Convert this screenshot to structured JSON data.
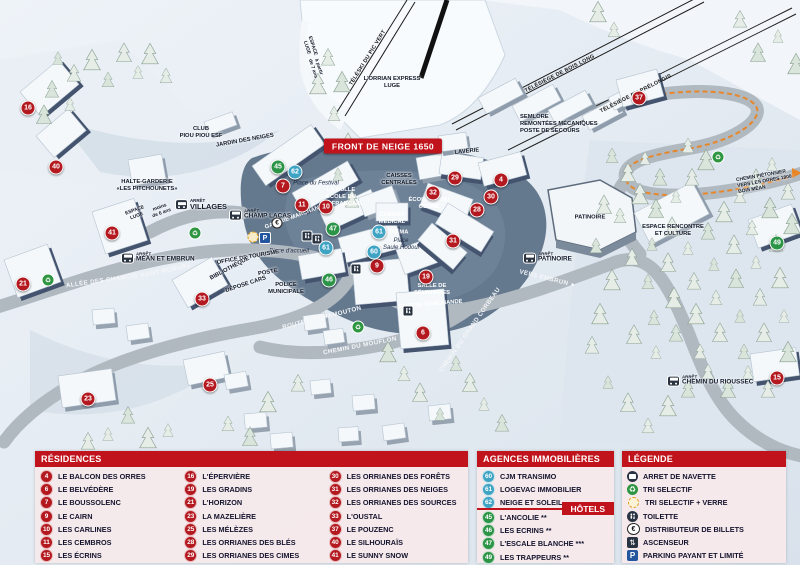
{
  "colors": {
    "accent_red": "#c1131b",
    "marker_red": "#b3191f",
    "marker_green": "#2c9447",
    "marker_blue": "#3fa3c4",
    "trail_orange": "#e8872a",
    "parking_blue": "#2456a0"
  },
  "map": {
    "banner": "FRONT DE NEIGE 1650",
    "markers": [
      {
        "n": "16",
        "c": "red",
        "x": 28,
        "y": 108
      },
      {
        "n": "40",
        "c": "red",
        "x": 56,
        "y": 167
      },
      {
        "n": "21",
        "c": "red",
        "x": 23,
        "y": 284
      },
      {
        "n": "41",
        "c": "red",
        "x": 112,
        "y": 233
      },
      {
        "n": "33",
        "c": "red",
        "x": 202,
        "y": 299
      },
      {
        "n": "23",
        "c": "red",
        "x": 88,
        "y": 399
      },
      {
        "n": "25",
        "c": "red",
        "x": 210,
        "y": 385
      },
      {
        "n": "7",
        "c": "red",
        "x": 283,
        "y": 186
      },
      {
        "n": "11",
        "c": "red",
        "x": 302,
        "y": 205
      },
      {
        "n": "10",
        "c": "red",
        "x": 326,
        "y": 207
      },
      {
        "n": "9",
        "c": "red",
        "x": 377,
        "y": 266
      },
      {
        "n": "19",
        "c": "red",
        "x": 426,
        "y": 277
      },
      {
        "n": "6",
        "c": "red",
        "x": 423,
        "y": 333
      },
      {
        "n": "29",
        "c": "red",
        "x": 455,
        "y": 178
      },
      {
        "n": "4",
        "c": "red",
        "x": 501,
        "y": 180
      },
      {
        "n": "30",
        "c": "red",
        "x": 491,
        "y": 197
      },
      {
        "n": "32",
        "c": "red",
        "x": 433,
        "y": 193
      },
      {
        "n": "28",
        "c": "red",
        "x": 477,
        "y": 210
      },
      {
        "n": "31",
        "c": "red",
        "x": 453,
        "y": 241
      },
      {
        "n": "37",
        "c": "red",
        "x": 639,
        "y": 98
      },
      {
        "n": "15",
        "c": "red",
        "x": 777,
        "y": 378
      },
      {
        "n": "45",
        "c": "green",
        "x": 278,
        "y": 167
      },
      {
        "n": "47",
        "c": "green",
        "x": 333,
        "y": 229
      },
      {
        "n": "46",
        "c": "green",
        "x": 329,
        "y": 280
      },
      {
        "n": "49",
        "c": "green",
        "x": 777,
        "y": 243
      },
      {
        "n": "62",
        "c": "blue",
        "x": 295,
        "y": 172
      },
      {
        "n": "61",
        "c": "blue",
        "x": 326,
        "y": 248
      },
      {
        "n": "60",
        "c": "blue",
        "x": 374,
        "y": 252
      },
      {
        "n": "61",
        "c": "blue",
        "x": 379,
        "y": 232
      }
    ],
    "labels": [
      {
        "t": "LAVERIE",
        "x": 467,
        "y": 152,
        "r": -6,
        "c": "dk"
      },
      {
        "t": "CAISSES\nCENTRALES",
        "x": 399,
        "y": 180,
        "r": 0,
        "c": "dk"
      },
      {
        "t": "ÉCOLE DE SKI\nOZONE",
        "x": 429,
        "y": 204,
        "r": 0,
        "c": "wt"
      },
      {
        "t": "LA BULLE\nÉCOLE DU\nSKI FRANÇAIS",
        "x": 341,
        "y": 197,
        "r": 0,
        "c": "wt"
      },
      {
        "t": "GALERIE MARCHANDE",
        "x": 296,
        "y": 217,
        "r": -20,
        "c": "wt"
      },
      {
        "t": "CABINET\nMÉDICAL",
        "x": 392,
        "y": 219,
        "r": 0,
        "c": "wt"
      },
      {
        "t": "CINÉMA",
        "x": 397,
        "y": 233,
        "r": 0,
        "c": "wt"
      },
      {
        "t": "SALLE DE\nSÉMINAIRES",
        "x": 432,
        "y": 290,
        "r": 0,
        "c": "wt"
      },
      {
        "t": "GALERIE MARCHANDE",
        "x": 430,
        "y": 305,
        "r": -5,
        "c": "wt"
      },
      {
        "t": "Place du Festival",
        "x": 316,
        "y": 184,
        "r": 0,
        "c": "it"
      },
      {
        "t": "Place d'accueil",
        "x": 289,
        "y": 252,
        "r": 0,
        "c": "it"
      },
      {
        "t": "Place\nSaule Hodoul",
        "x": 401,
        "y": 245,
        "r": 0,
        "c": "it"
      },
      {
        "t": "OFFICE DE TOURISME",
        "x": 248,
        "y": 258,
        "r": -10,
        "c": "dk"
      },
      {
        "t": "BIBLIOTHÈQUE",
        "x": 230,
        "y": 269,
        "r": -28,
        "c": "dk"
      },
      {
        "t": "POSTE",
        "x": 268,
        "y": 273,
        "r": -10,
        "c": "dk"
      },
      {
        "t": "DÉPOSE CARS",
        "x": 246,
        "y": 285,
        "r": -18,
        "c": "dk"
      },
      {
        "t": "POLICE\nMUNICIPALE",
        "x": 286,
        "y": 289,
        "r": 0,
        "c": "dk"
      },
      {
        "t": "HALTE-GARDERIE\n«LES PITCHOUNETS»",
        "x": 147,
        "y": 186,
        "r": 0,
        "c": "dk"
      },
      {
        "t": "CLUB\nPIOU PIOU ESF",
        "x": 201,
        "y": 133,
        "r": 0,
        "c": "dk"
      },
      {
        "t": "JARDIN DES NEIGES",
        "x": 245,
        "y": 141,
        "r": -10,
        "c": "dk"
      },
      {
        "t": "ESPACE\nLUGE",
        "x": 136,
        "y": 214,
        "r": -20,
        "c": "dk",
        "s": true
      },
      {
        "t": "moins\nde 6 ans",
        "x": 161,
        "y": 211,
        "r": -20,
        "c": "dk",
        "s": true
      },
      {
        "t": "ESPACE\nLUGE",
        "x": 309,
        "y": 47,
        "r": 72,
        "c": "dk",
        "s": true
      },
      {
        "t": "à partir\nde 7 ans",
        "x": 315,
        "y": 68,
        "r": 72,
        "c": "dk",
        "s": true
      },
      {
        "t": "ESPACE RENCONTRE\nET CULTURE",
        "x": 673,
        "y": 231,
        "r": 0,
        "c": "dk"
      },
      {
        "t": "PATINOIRE",
        "x": 590,
        "y": 218,
        "r": 0,
        "c": "dk"
      },
      {
        "t": "L'ORRIAN EXPRESS\nLUGE",
        "x": 392,
        "y": 83,
        "r": 0,
        "c": "dk"
      },
      {
        "t": "SEMLORE\nREMONTÉES MÉCANIQUES\nPOSTE DE SECOURS",
        "x": 520,
        "y": 124,
        "r": 0,
        "c": "dk",
        "a": "left"
      },
      {
        "t": "CHEMIN PIÉTONNIER\nVERS LES ORRES 1800\nBOIS MÉAN",
        "x": 737,
        "y": 182,
        "r": -10,
        "c": "dk",
        "s": true,
        "a": "left"
      },
      {
        "t": "ALLÉE DES CHAMOIS",
        "x": 102,
        "y": 281,
        "r": -8,
        "c": "road"
      },
      {
        "t": "PONT MOBURS",
        "x": 166,
        "y": 271,
        "r": -12,
        "c": "road"
      },
      {
        "t": "ROUTE DE PRAMOUTON",
        "x": 322,
        "y": 318,
        "r": -14,
        "c": "road"
      },
      {
        "t": "CHEMIN DU MOUFLON",
        "x": 360,
        "y": 346,
        "r": -11,
        "c": "road"
      },
      {
        "t": "CHEMIN DU GRAND CORBEAU",
        "x": 470,
        "y": 330,
        "r": -55,
        "c": "road"
      },
      {
        "t": "VERS EMBRUN ►",
        "x": 548,
        "y": 279,
        "r": 14,
        "c": "road"
      },
      {
        "t": "TÉLÉSKI DU PIC VERT",
        "x": 368,
        "y": 58,
        "r": -58,
        "c": "lift"
      },
      {
        "t": "TÉLÉSIÈGE DE BOIS LONG",
        "x": 560,
        "y": 74,
        "r": -27,
        "c": "lift"
      },
      {
        "t": "TÉLÉSIÈGE DU PRÉLONGIS",
        "x": 636,
        "y": 94,
        "r": -27,
        "c": "lift"
      }
    ],
    "stops": [
      {
        "small": "ARRÊT",
        "name": "VILLAGES",
        "x": 176,
        "y": 205,
        "big": true
      },
      {
        "small": "ARRÊT",
        "name": "CHAMP LACAS",
        "x": 230,
        "y": 215
      },
      {
        "small": "ARRÊT",
        "name": "MÉAN ET EMBRUN",
        "x": 122,
        "y": 258
      },
      {
        "small": "ARRÊT",
        "name": "PATINOIRE",
        "x": 524,
        "y": 258
      },
      {
        "small": "ARRÊT",
        "name": "CHEMIN DU RIOUSSEC",
        "x": 668,
        "y": 381
      }
    ],
    "icons": [
      {
        "type": "recycle",
        "x": 48,
        "y": 280
      },
      {
        "type": "recycle",
        "x": 195,
        "y": 233
      },
      {
        "type": "recycle",
        "x": 358,
        "y": 327
      },
      {
        "type": "recycle",
        "x": 718,
        "y": 157
      },
      {
        "type": "wc",
        "x": 307,
        "y": 236
      },
      {
        "type": "wc",
        "x": 317,
        "y": 239
      },
      {
        "type": "wc",
        "x": 356,
        "y": 269
      },
      {
        "type": "wc",
        "x": 408,
        "y": 311
      },
      {
        "type": "euro",
        "x": 277,
        "y": 223
      },
      {
        "type": "parking",
        "x": 265,
        "y": 238
      },
      {
        "type": "glass",
        "x": 253,
        "y": 237
      }
    ]
  },
  "legend": {
    "residences": {
      "title": "RÉSIDENCES",
      "items": [
        {
          "n": "4",
          "label": "LE BALCON DES ORRES"
        },
        {
          "n": "6",
          "label": "LE BELVÉDÈRE"
        },
        {
          "n": "7",
          "label": "LE BOUSSOLENC"
        },
        {
          "n": "9",
          "label": "LE CAIRN"
        },
        {
          "n": "10",
          "label": "LES CARLINES"
        },
        {
          "n": "11",
          "label": "LES CEMBROS"
        },
        {
          "n": "15",
          "label": "LES ÉCRINS"
        },
        {
          "n": "16",
          "label": "L'ÉPERVIÈRE"
        },
        {
          "n": "19",
          "label": "LES GRADINS"
        },
        {
          "n": "21",
          "label": "L'HORIZON"
        },
        {
          "n": "23",
          "label": "LA MAZELIÈRE"
        },
        {
          "n": "25",
          "label": "LES MÉLÈZES"
        },
        {
          "n": "28",
          "label": "LES ORRIANES DES BLÉS"
        },
        {
          "n": "29",
          "label": "LES ORRIANES DES CIMES"
        },
        {
          "n": "30",
          "label": "LES ORRIANES DES FORÊTS"
        },
        {
          "n": "31",
          "label": "LES ORRIANES DES NEIGES"
        },
        {
          "n": "32",
          "label": "LES ORRIANES DES SOURCES"
        },
        {
          "n": "33",
          "label": "L'OUSTAL"
        },
        {
          "n": "37",
          "label": "LE POUZENC"
        },
        {
          "n": "40",
          "label": "LE SILHOURAÏS"
        },
        {
          "n": "41",
          "label": "LE SUNNY SNOW"
        }
      ]
    },
    "agences": {
      "title": "AGENCES IMMOBILIÈRES",
      "items": [
        {
          "n": "60",
          "label": "CJM TRANSIMO"
        },
        {
          "n": "61",
          "label": "LOGEVAC IMMOBILIER"
        },
        {
          "n": "62",
          "label": "NEIGE ET SOLEIL"
        }
      ]
    },
    "hotels": {
      "title": "HÔTELS",
      "items": [
        {
          "n": "45",
          "label": "L'ANCOLIE **"
        },
        {
          "n": "46",
          "label": "LES ECRINS **"
        },
        {
          "n": "47",
          "label": "L'ESCALE BLANCHE ***"
        },
        {
          "n": "49",
          "label": "LES TRAPPEURS **"
        }
      ]
    },
    "legende": {
      "title": "LÉGENDE",
      "items": [
        {
          "icon": "bus",
          "label": "ARRET DE NAVETTE"
        },
        {
          "icon": "recycle",
          "label": "TRI SELECTIF"
        },
        {
          "icon": "glass",
          "label": "TRI SELECTIF + VERRE"
        },
        {
          "icon": "wc",
          "label": "TOILETTE"
        },
        {
          "icon": "euro",
          "label": "DISTRIBUTEUR DE BILLETS"
        },
        {
          "icon": "elevator",
          "label": "ASCENSEUR"
        },
        {
          "icon": "parking",
          "label": "PARKING PAYANT ET LIMITÉ"
        }
      ]
    }
  }
}
